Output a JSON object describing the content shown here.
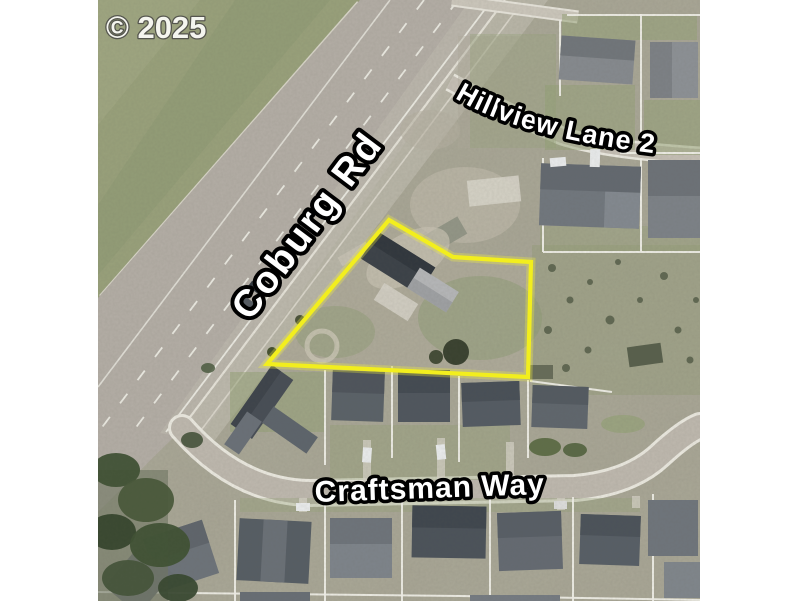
{
  "map": {
    "copyright": "© 2025",
    "streets": {
      "main_road": "Coburg Rd",
      "north_street": "Hillview Lane 2",
      "south_street": "Craftsman Way"
    }
  },
  "parcel": {
    "outline_points": "389,220 453,257 531,262 528,377 267,364"
  },
  "colors": {
    "parcel_outline": "#f2ee1e",
    "label_fill": "#ffffff",
    "label_outline": "#000000",
    "field_green": "#99a17b",
    "road_gray": "#b4aea6",
    "margin_white": "#ffffff"
  }
}
